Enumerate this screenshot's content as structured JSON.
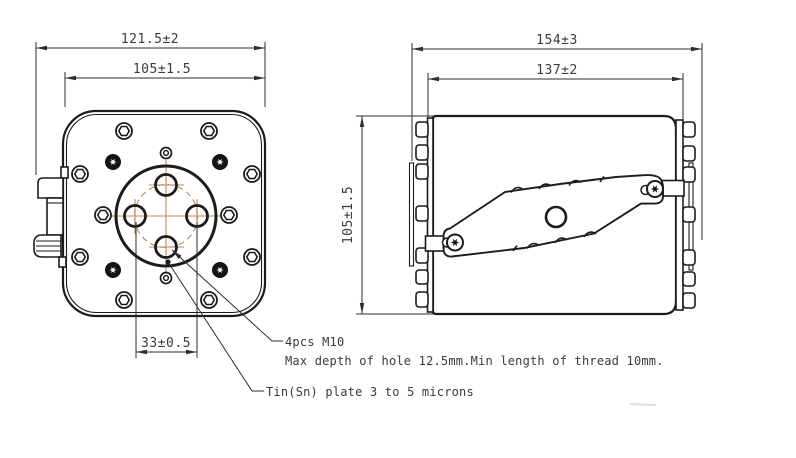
{
  "front_view": {
    "dims": {
      "overall_width": "121.5±2",
      "flange_width": "105±1.5",
      "hole_spacing": "33±0.5"
    },
    "notes": {
      "holes_label": "4pcs M10",
      "holes_detail": "Max depth of hole 12.5mm.Min length of thread 10mm.",
      "plating": "Tin(Sn) plate 3 to 5 microns"
    }
  },
  "side_view": {
    "dims": {
      "overall_length": "154±3",
      "body_length": "137±2",
      "height": "105±1.5"
    }
  },
  "colors": {
    "outline": "#1c1c1c",
    "centerline": "#bd8a52",
    "dimension_text": "#3b3b3b"
  }
}
